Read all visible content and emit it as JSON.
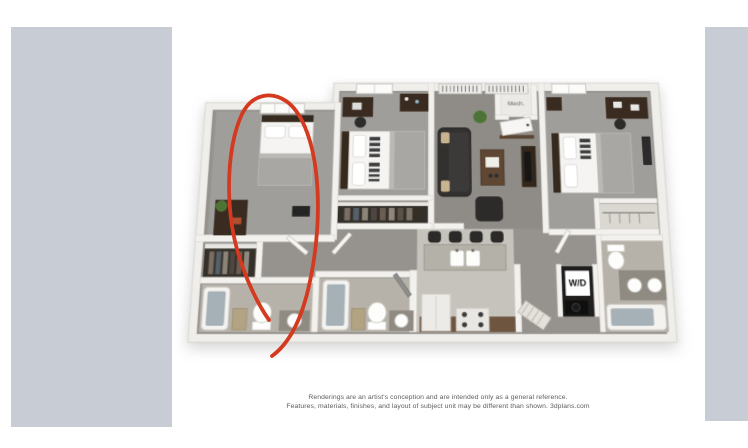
{
  "image_viewer": {
    "background": "#ffffff",
    "side_panel_color": "#c8ccd4"
  },
  "floorplan": {
    "type": "3d-rendered-apartment-floor-plan",
    "rooms_depicted": [
      "bedroom-left",
      "bedroom-middle",
      "bedroom-right",
      "living-room",
      "kitchen-with-breakfast-bar",
      "bathroom-left",
      "bathroom-middle",
      "bathroom-right",
      "mech-closet",
      "laundry-closet",
      "closets"
    ],
    "mech_label": "Mech.",
    "wd_label": "W/D",
    "annotation": {
      "color": "#d43a20",
      "description": "hand-drawn red oval around left bedroom with tail ending at left bathroom toilet"
    }
  },
  "disclaimer": {
    "line1": "Renderings are an artist's conception and are intended only as a general reference.",
    "line2": "Features, materials, finishes, and layout of subject unit may be different than shown. 3dplans.com"
  }
}
